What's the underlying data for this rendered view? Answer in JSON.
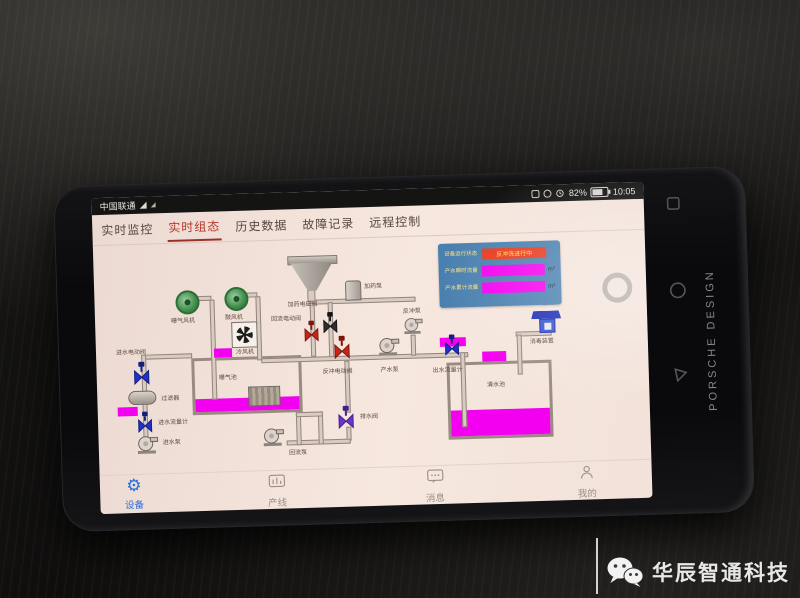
{
  "scene": {
    "watermark": "华辰智通科技"
  },
  "phone": {
    "brand": "PORSCHE DESIGN"
  },
  "status_bar": {
    "carrier": "中国联通",
    "battery": "82%",
    "time": "10:05"
  },
  "tab_bar": {
    "tabs": [
      {
        "label": "实时监控",
        "active": false
      },
      {
        "label": "实时组态",
        "active": true
      },
      {
        "label": "历史数据",
        "active": false
      },
      {
        "label": "故障记录",
        "active": false
      },
      {
        "label": "远程控制",
        "active": false
      }
    ]
  },
  "info_panel": {
    "rows": [
      {
        "label": "设备运行状态",
        "value": "反冲洗进行中",
        "unit": ""
      },
      {
        "label": "产水瞬时流量",
        "value": "",
        "unit": "m³"
      },
      {
        "label": "产水累计流量",
        "value": "",
        "unit": "m³"
      }
    ]
  },
  "diagram": {
    "labels": {
      "blower1": "曝气风机",
      "blower2": "鼓风机",
      "fan": "冷风机",
      "dosing_pump": "加药泵",
      "dosing_valve": "加药电磁阀",
      "backwash_pump": "反冲泵",
      "return_valve": "回流电动阀",
      "backwash_valve": "反冲电动阀",
      "product_pump": "产水泵",
      "outlet_flowmeter": "出水流量计",
      "chlorine": "加氯",
      "disinfector": "消毒装置",
      "clean_tank": "清水池",
      "aeration_tank": "曝气池",
      "inlet_valve": "进水电动阀",
      "filter": "过滤器",
      "inlet_flowmeter": "进水流量计",
      "inlet_pump": "进水泵",
      "return_pump": "回流泵",
      "drain_valve": "排水阀"
    }
  },
  "bottom_nav": {
    "items": [
      {
        "label": "设备",
        "active": true
      },
      {
        "label": "产线",
        "active": false
      },
      {
        "label": "消息",
        "active": false
      },
      {
        "label": "我的",
        "active": false
      }
    ]
  }
}
